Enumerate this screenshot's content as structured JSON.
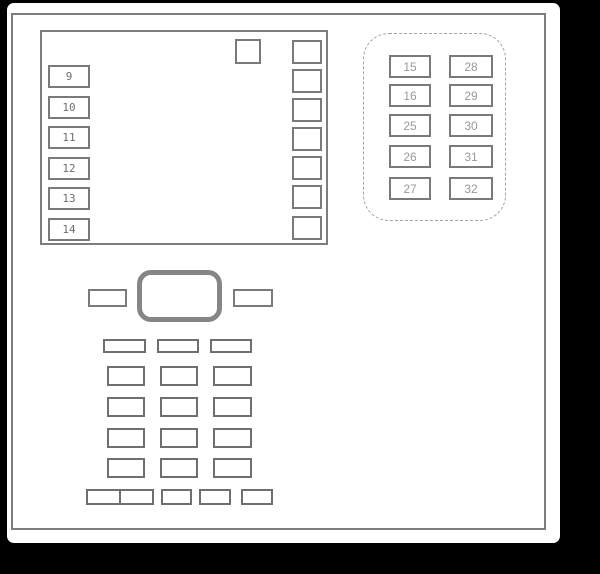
{
  "colors": {
    "background": "#000000",
    "page": "#ffffff",
    "outline_gray": "#7d7d7d",
    "box_border_gray": "#7a7a7a",
    "slot_border_gray": "#6f6f6f",
    "thick_block_gray": "#868686",
    "dashed_border_gray": "#a3a3a3",
    "panel_a_label_color": "#6e6e6e",
    "panel_b_label_color": "#9a9a9a"
  },
  "panel_a": {
    "fuse_labels": [
      "9",
      "10",
      "11",
      "12",
      "13",
      "14"
    ]
  },
  "panel_b": {
    "left_column": [
      "15",
      "16",
      "25",
      "26",
      "27"
    ],
    "right_column": [
      "28",
      "29",
      "30",
      "31",
      "32"
    ]
  }
}
